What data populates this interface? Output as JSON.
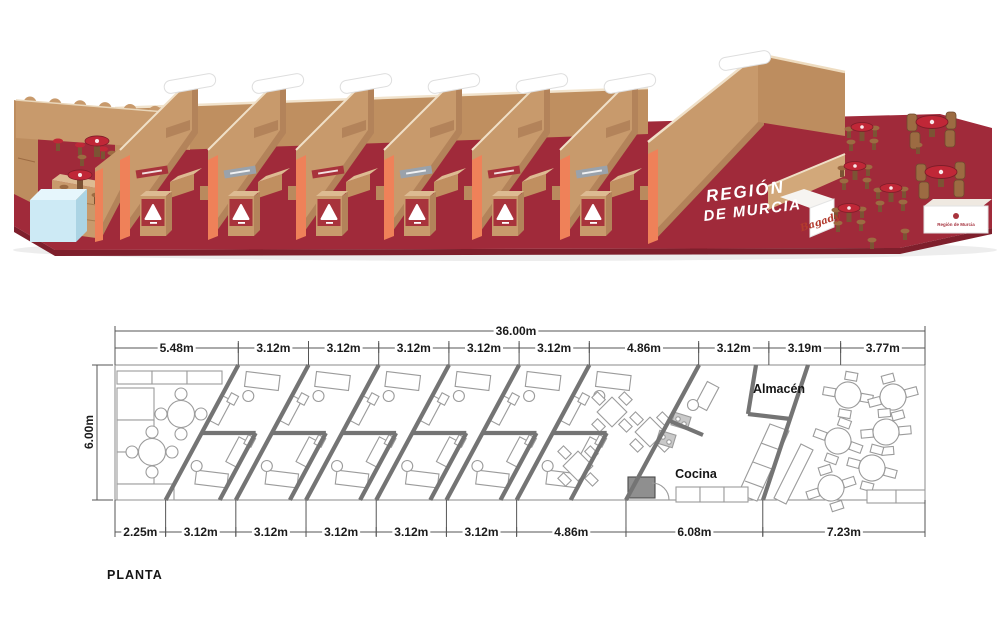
{
  "plan": {
    "title": "PLANTA",
    "total_width_label": "36.00m",
    "height_label": "6.00m",
    "total_width_m": 36.0,
    "height_m": 6.0,
    "top_segments": [
      "5.48m",
      "3.12m",
      "3.12m",
      "3.12m",
      "3.12m",
      "3.12m",
      "4.86m",
      "3.12m",
      "3.19m",
      "3.77m"
    ],
    "top_segments_m": [
      5.48,
      3.12,
      3.12,
      3.12,
      3.12,
      3.12,
      4.86,
      3.12,
      3.19,
      3.77
    ],
    "bottom_segments": [
      "2.25m",
      "3.12m",
      "3.12m",
      "3.12m",
      "3.12m",
      "3.12m",
      "4.86m",
      "6.08m",
      "7.23m"
    ],
    "bottom_segments_m": [
      2.25,
      3.12,
      3.12,
      3.12,
      3.12,
      3.12,
      4.86,
      6.08,
      7.23
    ],
    "storage_label": "Almacén",
    "kitchen_label": "Cocina"
  },
  "render": {
    "floor_title_line1": "REGIÓN",
    "floor_title_line2": "DE MURCIA",
    "signature": "Bagady",
    "counter_logo": "Región de Murcia",
    "colors": {
      "carpet": "#a02a3a",
      "carpet_edge": "#7e1f2c",
      "cardboard": "#c89a6c",
      "cardboard_dark": "#b3835a",
      "cardboard_light": "#ddbb92",
      "accent_orange": "#ef8159",
      "sign_red": "#a8333c",
      "sign_gray": "#9aa2ab",
      "cube_blue": "#cdeaf5",
      "table_red": "#c02737",
      "stool_brown": "#9c6b42",
      "stool_dark": "#7c5334"
    }
  }
}
